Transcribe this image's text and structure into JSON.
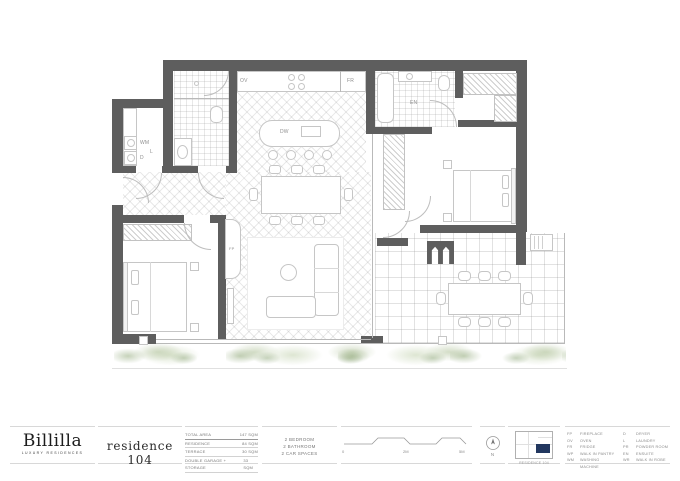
{
  "brand": {
    "name": "Billilla",
    "tagline": "LUXURY RESIDENCES"
  },
  "title": "residence 104",
  "area_table": {
    "rows": [
      {
        "label": "TOTAL AREA",
        "value": "147 SQM"
      },
      {
        "label": "RESIDENCE",
        "value": "84 SQM"
      },
      {
        "label": "TERRACE",
        "value": "30 SQM"
      },
      {
        "label": "DOUBLE GARAGE + STORAGE",
        "value": "33 SQM"
      }
    ]
  },
  "features": [
    "2 BEDROOM",
    "2 BATHROOM",
    "2 CAR SPACES"
  ],
  "scale_bar": {
    "labels": [
      "0",
      "2M",
      "5M"
    ]
  },
  "north": {
    "label": "N"
  },
  "key_plan": {
    "caption": "RESIDENCE 104",
    "accent_color": "#22375f"
  },
  "legend": {
    "column1": [
      [
        "FP",
        "FIREPLACE"
      ],
      [
        "OV",
        "OVEN"
      ],
      [
        "FR",
        "FRIDGE"
      ],
      [
        "WP",
        "WALK IN PANTRY"
      ],
      [
        "WM",
        "WASHING MACHINE"
      ]
    ],
    "column2": [
      [
        "D",
        "DRYER"
      ],
      [
        "L",
        "LAUNDRY"
      ],
      [
        "PR",
        "POWDER ROOM"
      ],
      [
        "EN",
        "ENSUITE"
      ],
      [
        "WR",
        "WALK IN ROBE"
      ]
    ]
  },
  "plan_labels": {
    "oven": "OV",
    "fridge": "FR",
    "dishwasher": "DW",
    "ensuite": "EN",
    "laundry": "L",
    "washing_machine": "WM",
    "dryer": "D",
    "fireplace": "FP"
  },
  "colors": {
    "wall": "#5e5e5e",
    "navy": "#22375f",
    "green": "#b8c8a4"
  }
}
